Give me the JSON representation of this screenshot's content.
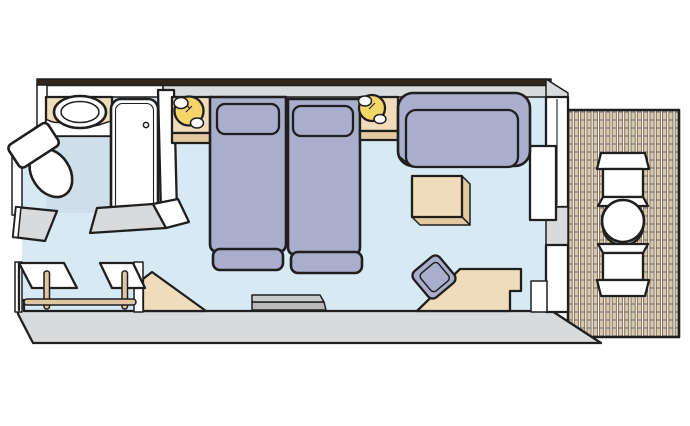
{
  "diagram": {
    "type": "cruise-stateroom-floor-plan",
    "areas": [
      "cabin",
      "bathroom",
      "entrance",
      "closet",
      "balcony"
    ],
    "furniture": [
      "toilet",
      "sink-vanity",
      "bathtub",
      "entrance-door",
      "bathroom-door",
      "wardrobe-shelves",
      "wardrobe-posts",
      "wardrobe-hanging-rail",
      "entry-step",
      "nightstand-left",
      "bedside-lamp-left",
      "twin-bed-left",
      "twin-bed-right",
      "bedside-lamp-right",
      "nightstand-right",
      "sofa",
      "coffee-table",
      "wall-shelf",
      "desk",
      "desk-chair",
      "sliding-glass-door",
      "balcony-chair-top",
      "balcony-round-table",
      "balcony-chair-bottom",
      "deck-planks"
    ]
  },
  "colors": {
    "outline": "#1f1f1f",
    "wall_dark": "#33261a",
    "wall_gray": "#d9dadb",
    "floor_main": "#d7e9f3",
    "floor_bath": "#cfdfe9",
    "furniture_blue": "#a9aecd",
    "furniture_beige": "#f0dcba",
    "furniture_beige_dark": "#e3c99f",
    "lamp_yellow": "#f3d568",
    "deck_plank": "#e0c6a2",
    "fixture_white": "#ffffff",
    "shelf_gray": "#c9cacb",
    "shelf_gray_dark": "#b9babb"
  }
}
